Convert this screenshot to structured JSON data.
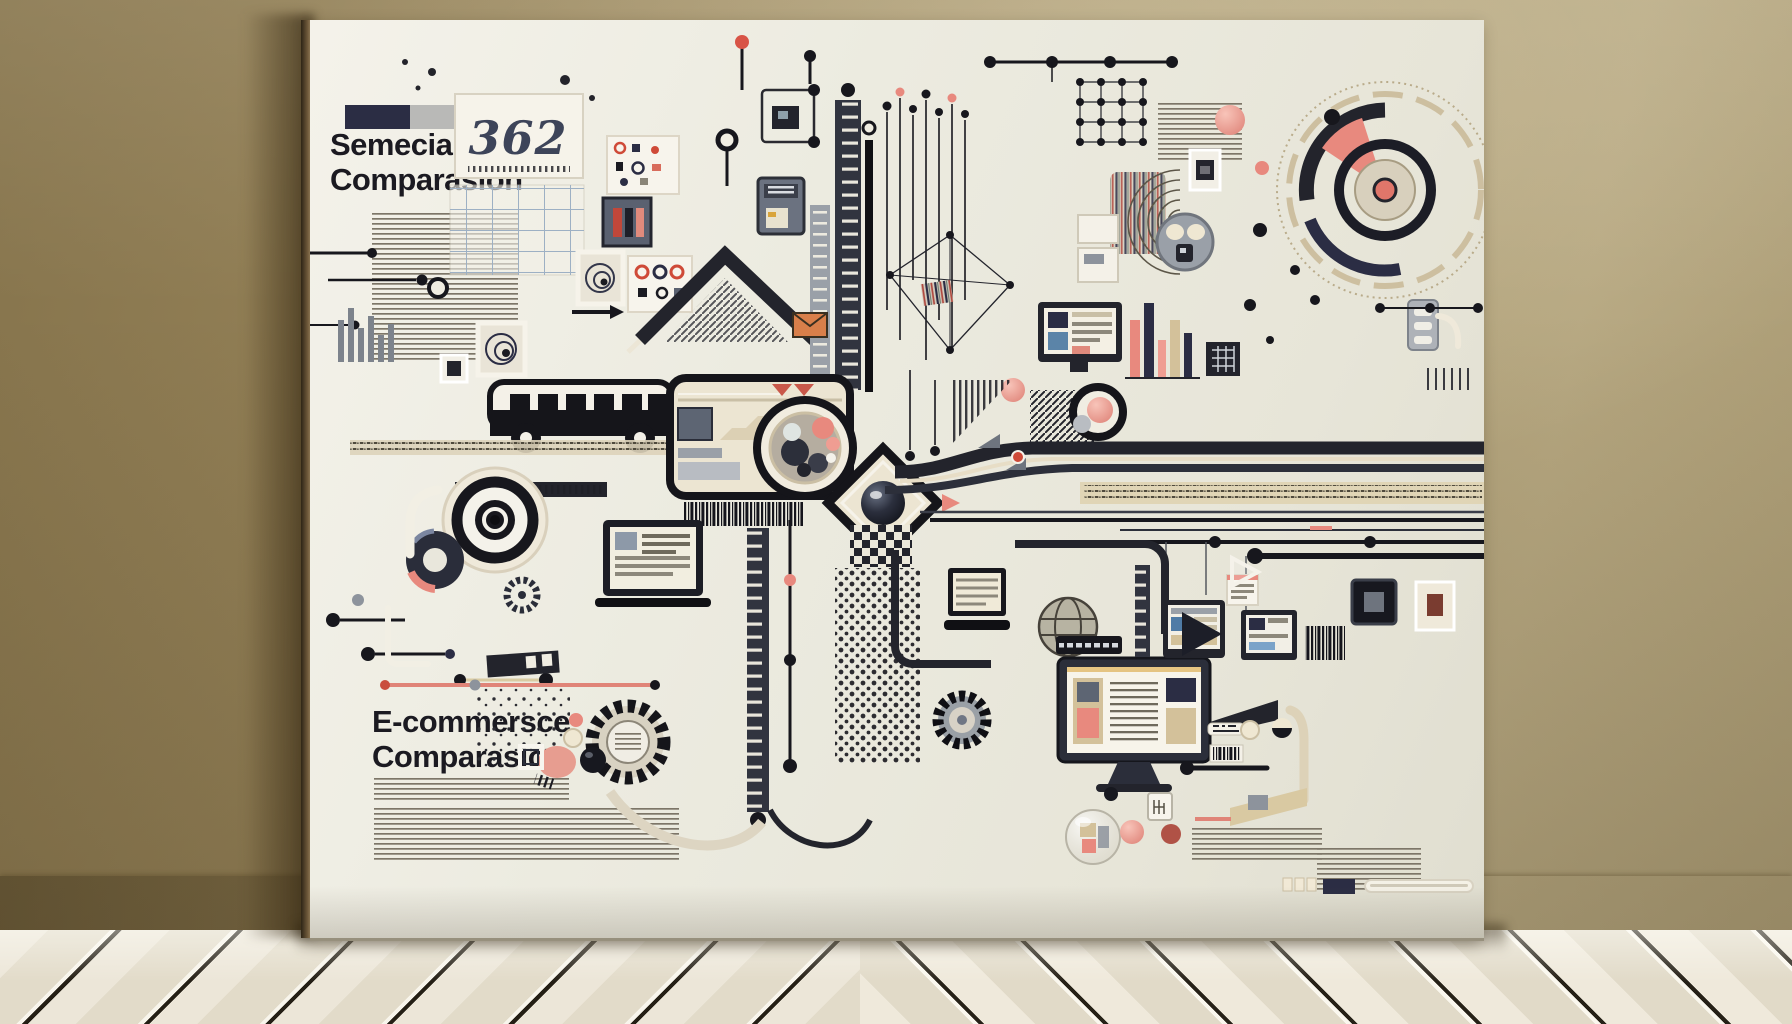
{
  "artwork": {
    "top_left": {
      "title_line1": "Semecial",
      "title_line2": "Comparasion",
      "stat_number": "362"
    },
    "bottom_left": {
      "title_line1": "E-commersce",
      "title_line2": "Comparasion"
    }
  },
  "palette": {
    "canvas": "#ebe9de",
    "ink": "#17171d",
    "navy": "#2b2d44",
    "slate": "#5d6573",
    "gray": "#9aa0a8",
    "salmon": "#e8897e",
    "pink": "#efa8a0",
    "coral": "#cf4a38",
    "tan": "#d3c19a",
    "beige": "#cdbb94",
    "cream": "#f1e9d6",
    "wall_left": "#8e7b52",
    "wall_right": "#b3a47e",
    "baseboard": "#f2f2ef",
    "floor_plank": "#e9e3d5",
    "floor_gap": "#24201a"
  }
}
